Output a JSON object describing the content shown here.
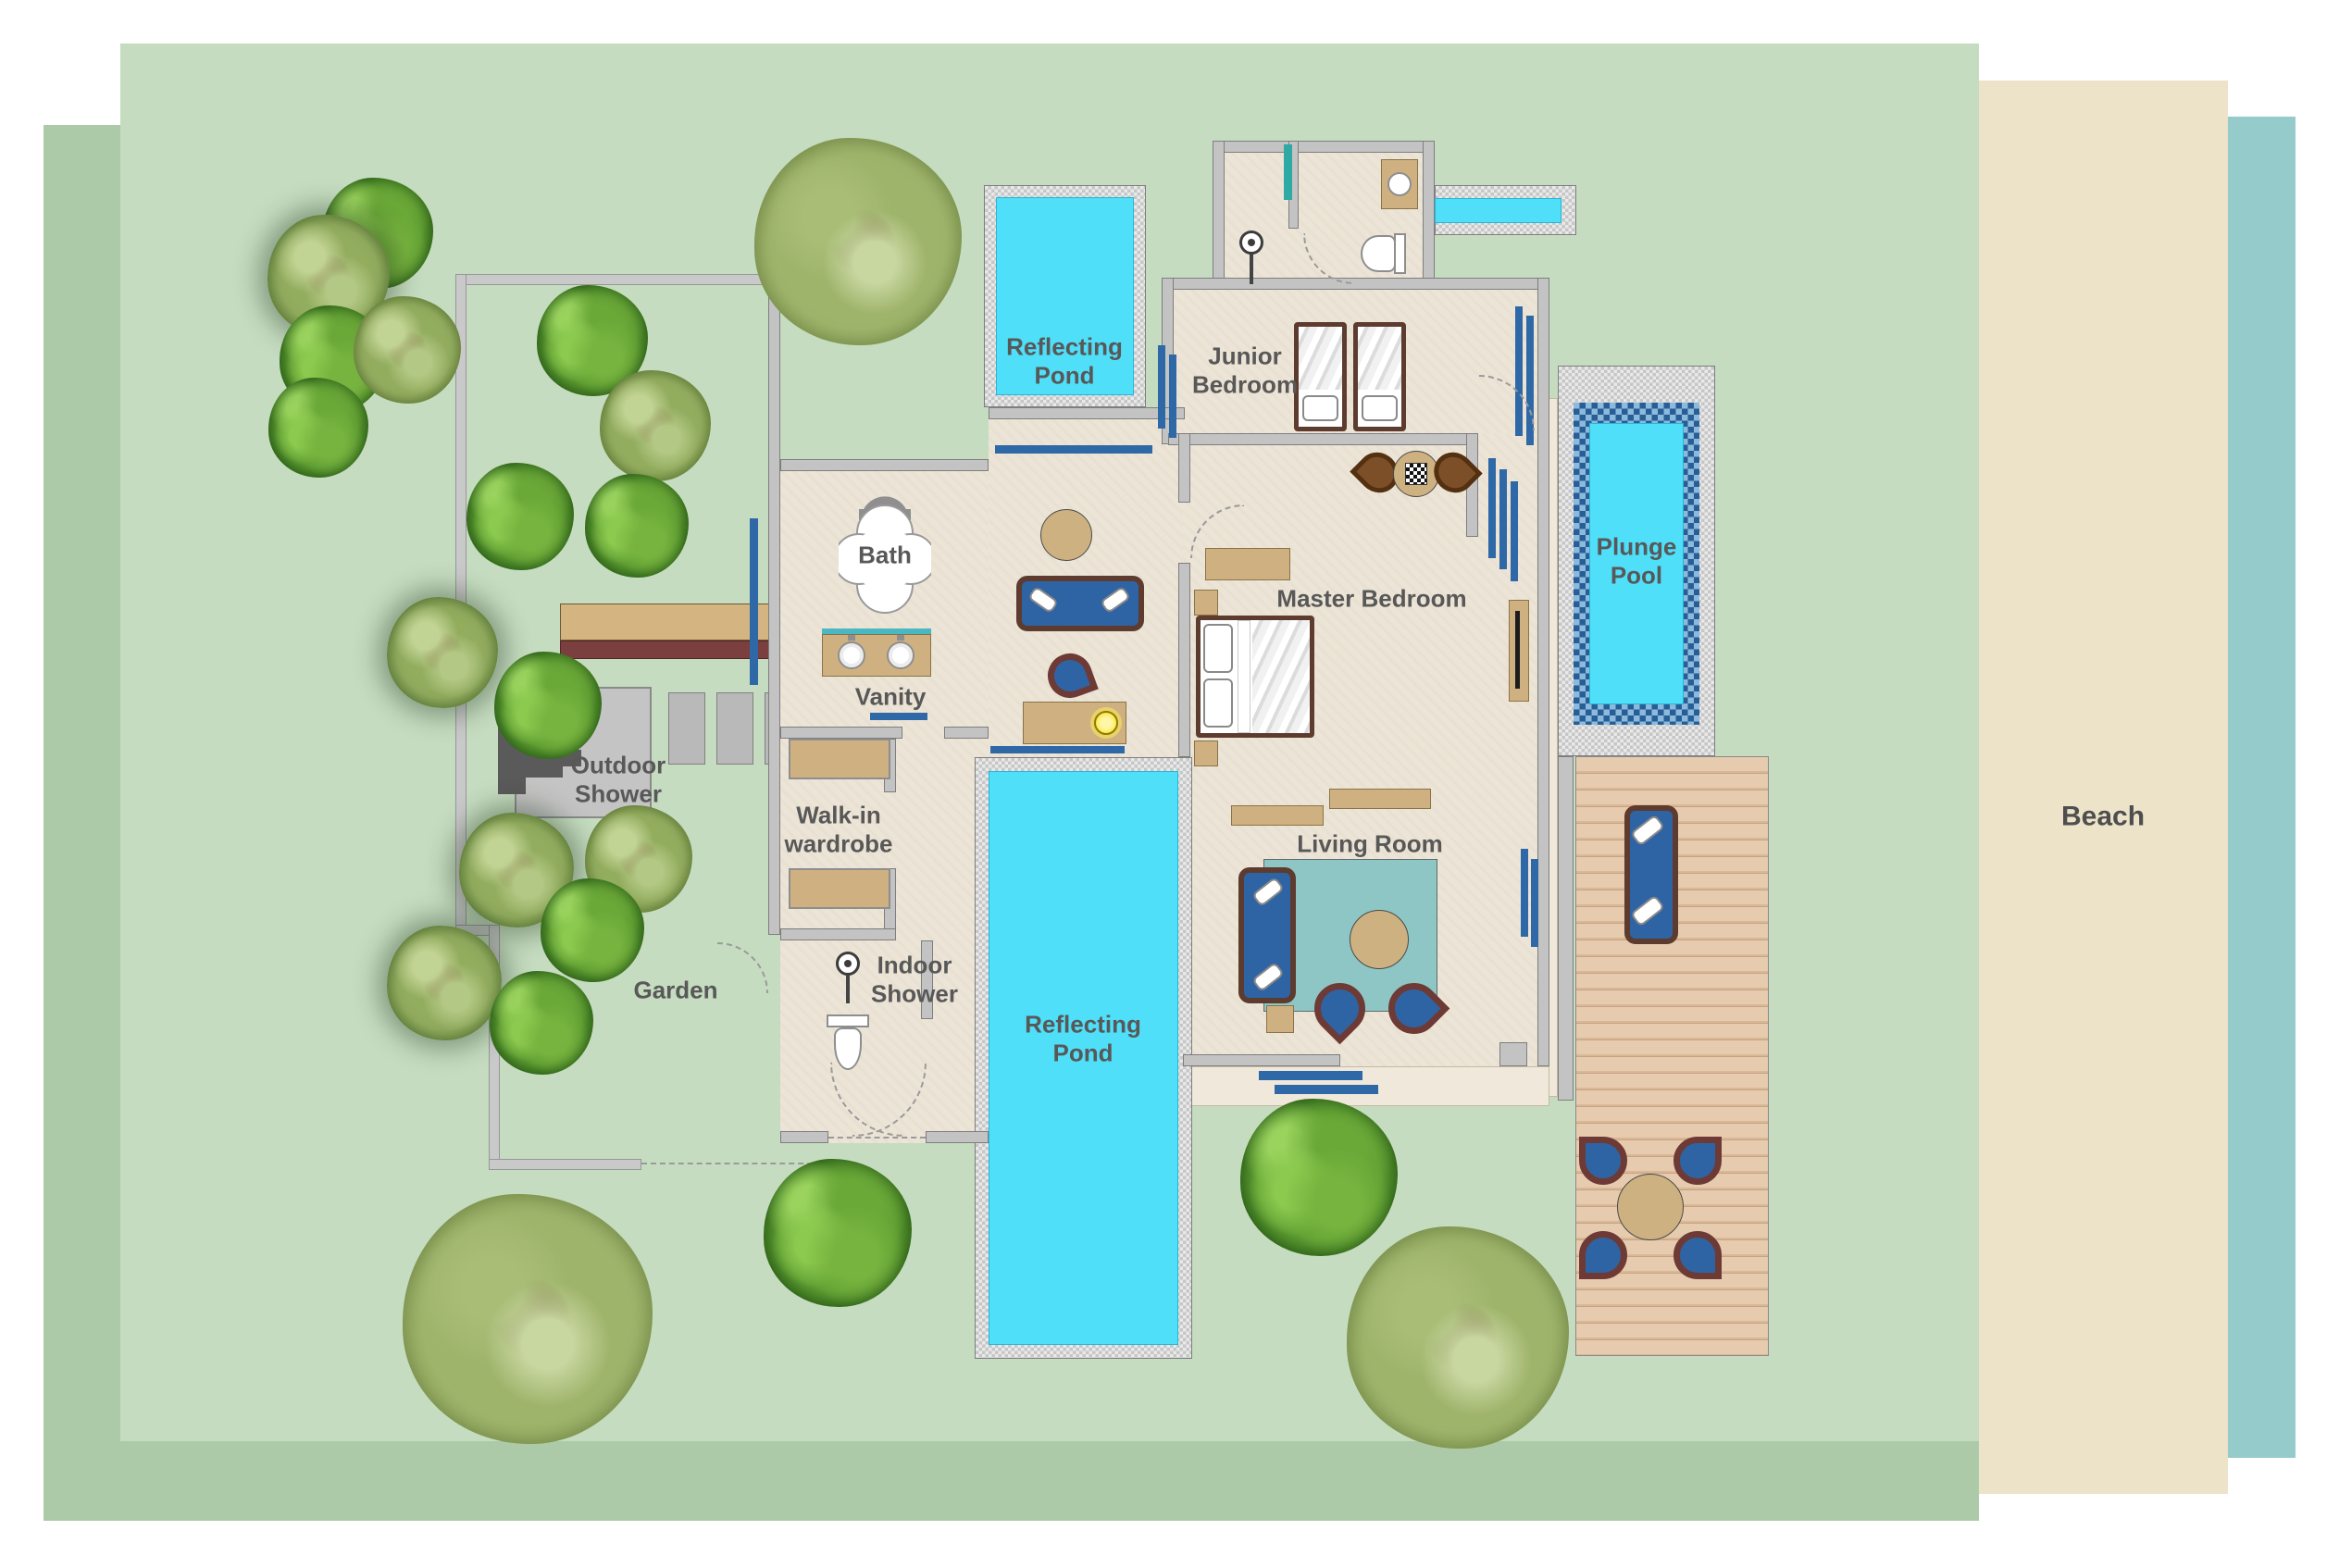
{
  "title": "Beach villa floor plan",
  "labels": {
    "pond_top": "Reflecting Pond",
    "junior_bedroom": "Junior Bedroom",
    "bath": "Bath",
    "vanity": "Vanity",
    "outdoor_shower": "Outdoor Shower",
    "walk_in_wardrobe": "Walk-in wardrobe",
    "indoor_shower": "Indoor Shower",
    "garden": "Garden",
    "pond_bottom": "Reflecting Pond",
    "master_bedroom": "Master Bedroom",
    "living_room": "Living Room",
    "plunge_pool": "Plunge Pool",
    "beach": "Beach"
  },
  "colors": {
    "water": "#4fdff9",
    "sea": "#95cbca",
    "sand": "#ece3c9",
    "grass_light": "#c5dcc0",
    "grass_dark": "#adcaa8",
    "floor": "#ece4d6",
    "wall": "#c3c3c3",
    "accent_blue": "#2e68a6",
    "furniture_blue": "#2f64a4",
    "wood_tan": "#cfb181",
    "frame_brown": "#5d3b2e",
    "chair_trim_maroon": "#6e3a35",
    "rug_teal": "#8ec6c5",
    "mosaic_blue": "#275e95",
    "label_gray": "#585858"
  }
}
